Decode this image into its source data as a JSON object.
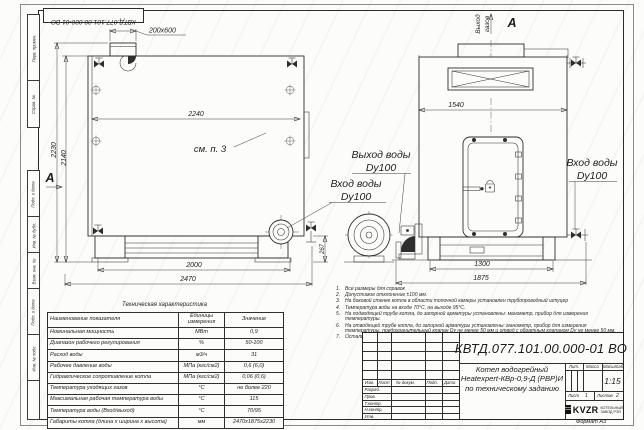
{
  "stamp": {
    "doc_number": "КВТД.077.101.00.000-01 ВО"
  },
  "frame": {
    "strip_labels": [
      "Перв. примен.",
      "Справ. №",
      "Подп. и дата",
      "Инв. № дубл.",
      "Взам. инв. №",
      "Подп. и дата",
      "Инв. № подл."
    ],
    "format_label": "Формат А3"
  },
  "front_view": {
    "dim_duct": "200х600",
    "dim_width_top": "2240",
    "see_note": "см. п. 3",
    "dim_height_total": "2230",
    "dim_height_body": "2140",
    "dim_base": "2000",
    "dim_length_total": "2470",
    "dim_inlet_height": "267",
    "section": "А"
  },
  "side_view": {
    "gas_outlet_line1": "Выход",
    "gas_outlet_line2": "газов",
    "section": "А",
    "dim_width": "1540",
    "dim_base": "1300",
    "dim_length_total": "1875"
  },
  "pipe_labels": {
    "outlet_line1": "Выход воды",
    "outlet_line2": "Dy100",
    "inlet_line1": "Вход воды",
    "inlet_line2": "Dy100",
    "inlet_side_line1": "Вход воды",
    "inlet_side_line2": "Dy100"
  },
  "notes": {
    "items": [
      {
        "n": "1.",
        "text": "Все размеры для справок"
      },
      {
        "n": "2.",
        "text": "Допустимое отклонение ±100 мм."
      },
      {
        "n": "3.",
        "text": "На боковой стенке котла в области топочной камеры установлен трубопроводный штуцер"
      },
      {
        "n": "4.",
        "text": "Температура воды на входе 70°С, на выходе 95°С."
      },
      {
        "n": "5.",
        "text": "На подводящей трубе котла, до запорной арматуры установлены: манометр, прибор для измерения температуры."
      },
      {
        "n": "6.",
        "text": "На отводящей трубе котла, до запорной арматуры установлены: манометр, прибор для измерения температуры, предохранительный клапан Dу не менее 50 мм и отвод с обратным клапаном Dу не менее 50 мм."
      },
      {
        "n": "7.",
        "text": "Остальные технические требования по ОСТ 108.030.113-84"
      }
    ]
  },
  "tech_table": {
    "title": "Техническая характеристика",
    "col_name": "Наименование показателя",
    "col_units": "Единицы измерения",
    "col_value": "Значение",
    "rows": [
      {
        "name": "Номинальная мощность",
        "units": "МВт",
        "value": "0,9"
      },
      {
        "name": "Диапазон рабочего регулирования",
        "units": "%",
        "value": "50-100"
      },
      {
        "name": "Расход воды",
        "units": "м3/ч",
        "value": "31"
      },
      {
        "name": "Рабочее давление воды",
        "units": "МПа (кгс/см2)",
        "value": "0,6 (6,0)"
      },
      {
        "name": "Гидравлическое сопротивление котла",
        "units": "МПа (кгс/см2)",
        "value": "0,06 (0,6)"
      },
      {
        "name": "Температура уходящих газов",
        "units": "°С",
        "value": "не более 220"
      },
      {
        "name": "Максимальная рабочая температура воды",
        "units": "°С",
        "value": "115"
      },
      {
        "name": "Температура воды (Вход/выход)",
        "units": "°С",
        "value": "70/95"
      },
      {
        "name": "Габариты котла (длина х ширина х высота)",
        "units": "мм",
        "value": "2470х1875х2230"
      }
    ]
  },
  "title_block": {
    "doc_number": "КВТД.077.101.00.000-01 ВО",
    "product_line1": "Котел водогрейный",
    "product_line2": "Heatexpert-КВр-0,9-Д (РВР)И",
    "product_line3": "по техническому заданию",
    "col_izm": "Изм.",
    "col_list": "Лист",
    "col_doc": "№ докум.",
    "col_podp": "Подп.",
    "col_data": "Дата",
    "role_razrab": "Разраб.",
    "role_prov": "Пров.",
    "role_tkontr": "Т.контр.",
    "role_nkontr": "Н.контр.",
    "role_utv": "Утв.",
    "lit_label": "Лит.",
    "mass_label": "Масса",
    "scale_label": "Масштаб",
    "scale_value": "1:15",
    "sheet_label": "Лист",
    "sheet_value": "1",
    "sheets_label": "Листов",
    "sheets_value": "2",
    "logo_word": "KVZR",
    "company_line1": "КОТЕЛЬНЫЙ",
    "company_line2": "ЗАВОД РЭП"
  }
}
